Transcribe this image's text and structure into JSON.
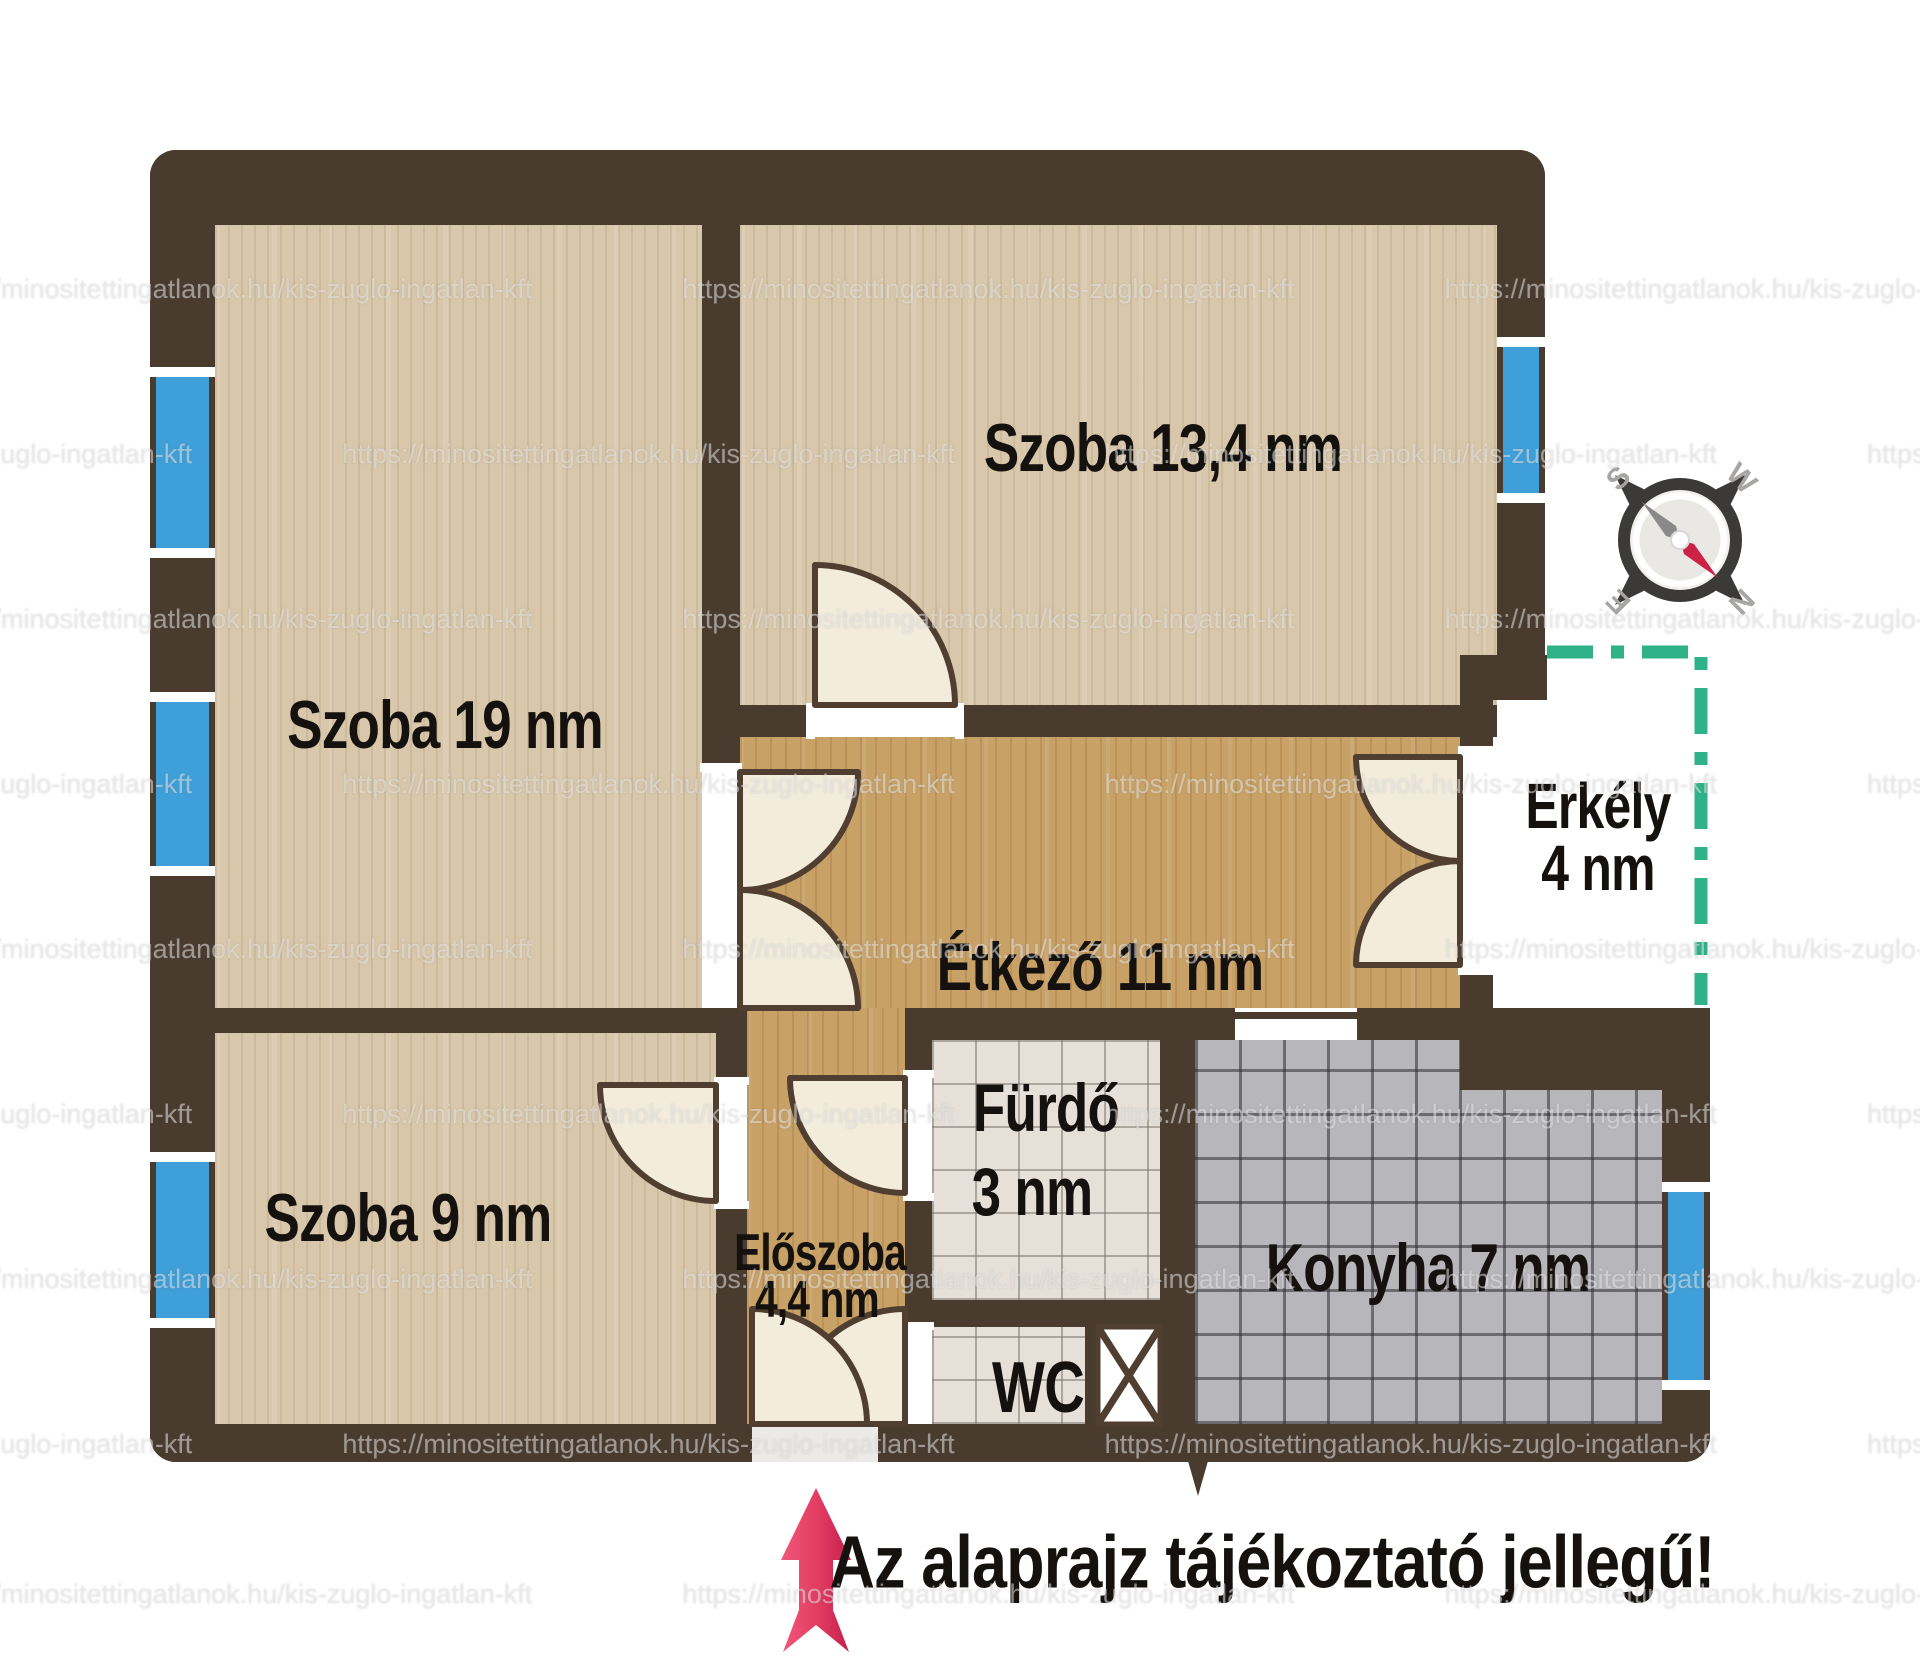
{
  "rooms": {
    "szoba19": {
      "label": "Szoba 19 nm"
    },
    "szoba134": {
      "label": "Szoba 13,4 nm"
    },
    "etkezo": {
      "label": "Étkező 11 nm"
    },
    "szoba9": {
      "label": "Szoba 9 nm"
    },
    "eloszoba": {
      "label": "Előszoba",
      "area": "4,4 nm"
    },
    "furdo": {
      "label": "Fürdő",
      "area": "3 nm"
    },
    "wc": {
      "label": "WC"
    },
    "konyha": {
      "label": "Konyha 7 nm"
    },
    "erkely": {
      "label": "Erkély",
      "area": "4 nm"
    }
  },
  "disclaimer": "Az alaprajz tájékoztató jellegű!",
  "compass": {
    "n": "N",
    "s": "S",
    "e": "E",
    "w": "W"
  },
  "watermark": {
    "text": "https://minositettingatlanok.hu/kis-zuglo-ingatlan-kft"
  },
  "colors": {
    "wall_brown": "#4a3b2f",
    "window_blue": "#3f9fd8",
    "balcony_dash_green": "#2fb287",
    "north_arrow_red": "#d92a52",
    "floor_wood_light": "#d9c7ab",
    "floor_wood_tan": "#c8a166",
    "tile_bath": "#e6e0d8",
    "tile_kitchen": "#b7b7bb",
    "door_leaf_cream": "#f3ecdc"
  }
}
